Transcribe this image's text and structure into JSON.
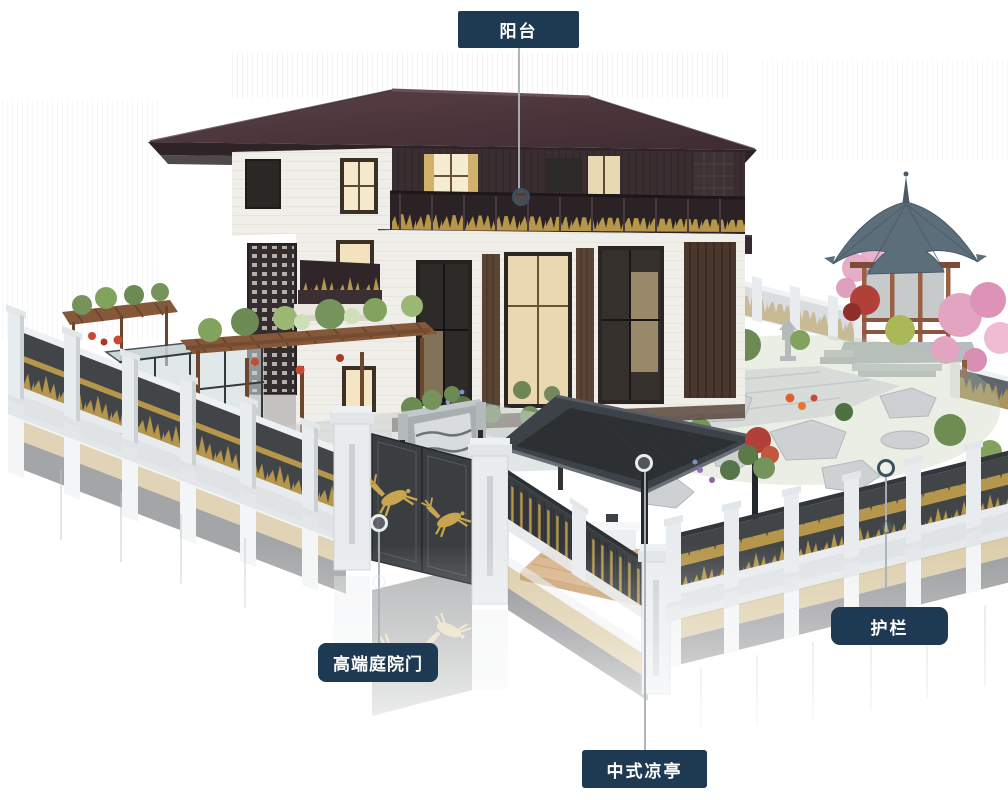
{
  "callouts": [
    {
      "id": "balcony",
      "label": "阳台"
    },
    {
      "id": "courtyard-gate",
      "label": "高端庭院门"
    },
    {
      "id": "pavilion",
      "label": "中式凉亭"
    },
    {
      "id": "railing",
      "label": "护栏"
    }
  ],
  "colors": {
    "page_bg": "#ffffff",
    "label_bg": "#1d3a52",
    "label_text": "#ffffff",
    "leader_line": "#aab2b8",
    "marker_dark": "#3a515f",
    "marker_light": "#e8edef",
    "roof_dark": "#4a343a",
    "wood_dark": "#3a2e31",
    "wall_white": "#f0eee8",
    "gold": "#b5964a",
    "fence_panel": "#424548",
    "fence_post": "#e9ecee",
    "modern_roof": "#3c4247",
    "gazebo_roof": "#5d6e7b",
    "gazebo_wood": "#9a6044",
    "deck_wood": "#d9b48a",
    "foliage": "#6b8a54",
    "blossom": "#e3a4c2",
    "rock": "#cdd1d4",
    "glass": "#c6d2d4",
    "pergola_wood": "#86583a",
    "flower_red": "#c84a32"
  }
}
